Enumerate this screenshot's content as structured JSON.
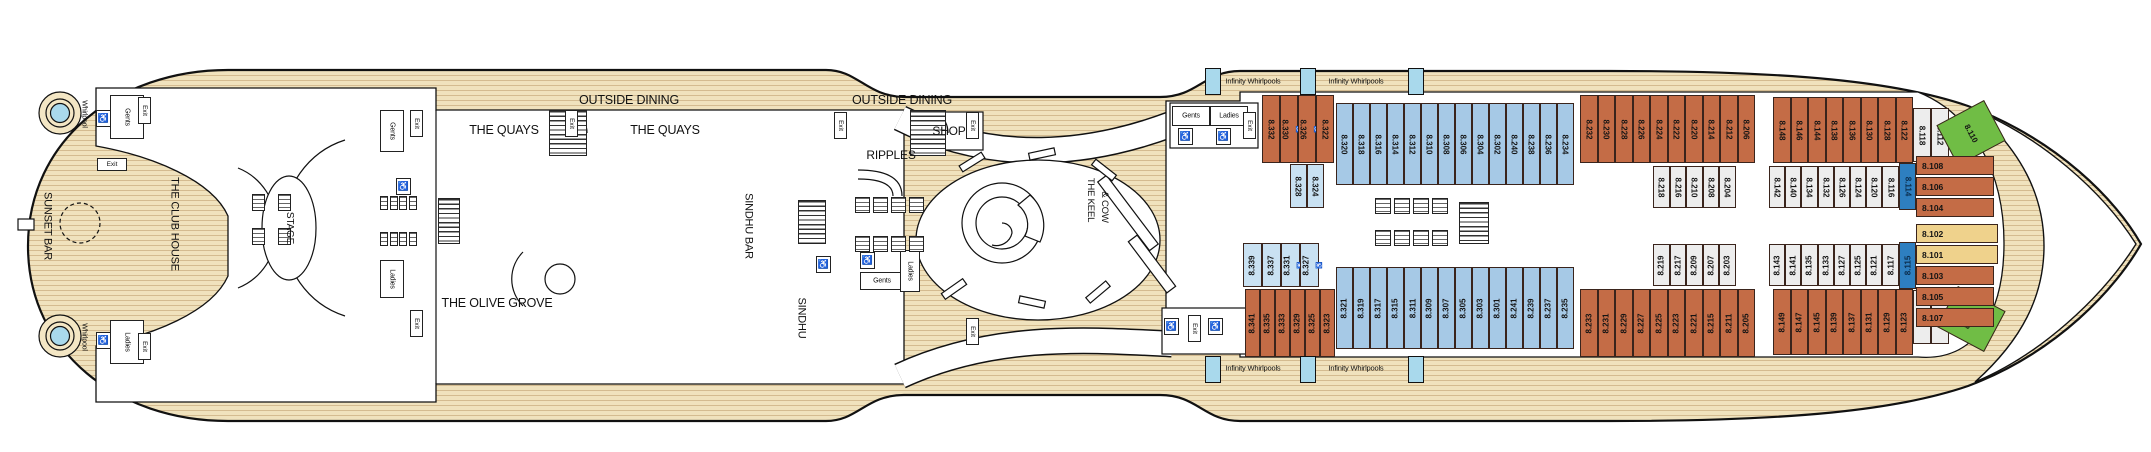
{
  "deck_plan": {
    "venues": {
      "sunset_bar": "SUNSET BAR",
      "club_house": "THE CLUB HOUSE",
      "stage": "STAGE",
      "quays": "THE QUAYS",
      "outside_dining": "OUTSIDE DINING",
      "olive_grove": "THE OLIVE GROVE",
      "sindhu_bar": "SINDHU BAR",
      "sindhu": "SINDHU",
      "ripples": "RIPPLES",
      "shop": "SHOP",
      "keel": "THE KEEL",
      "cow": "& COW",
      "infinity": "Infinity Whirlpools",
      "whirlpool": "Whirlpool",
      "gents": "Gents",
      "ladies": "Ladies",
      "exit": "Exit"
    },
    "colors": {
      "orange": "#c46c46",
      "blue": "#a6c9e6",
      "lightblue": "#c9e1f2",
      "white": "#ededed",
      "darkblue": "#2e7fc0",
      "yellow": "#efd28c",
      "green": "#70bd45",
      "wood": "#f0e2bd",
      "whirlpool_blue": "#a9d9ec"
    },
    "accessible_cabins": [
      "8.330",
      "8.326",
      "8.331",
      "8.327"
    ],
    "cabin_groups": [
      {
        "id": "top-orange-aft",
        "color": "orange",
        "cabins": [
          "8.332",
          "8.330",
          "8.326",
          "8.322"
        ]
      },
      {
        "id": "top-blue",
        "color": "blue",
        "cabins": [
          "8.320",
          "8.318",
          "8.316",
          "8.314",
          "8.312",
          "8.310",
          "8.308",
          "8.306",
          "8.304",
          "8.302",
          "8.240",
          "8.238",
          "8.236",
          "8.234"
        ]
      },
      {
        "id": "top-orange-mid",
        "color": "orange",
        "cabins": [
          "8.232",
          "8.230",
          "8.228",
          "8.226",
          "8.224",
          "8.222",
          "8.220",
          "8.214",
          "8.212",
          "8.206"
        ]
      },
      {
        "id": "top-orange-fwd",
        "color": "orange",
        "cabins": [
          "8.148",
          "8.146",
          "8.144",
          "8.138",
          "8.136",
          "8.130",
          "8.128",
          "8.122"
        ]
      },
      {
        "id": "top-white-fwd",
        "color": "white",
        "cabins": [
          "8.118",
          "8.112"
        ]
      },
      {
        "id": "top-green",
        "color": "green",
        "cabins": [
          "8.110"
        ]
      },
      {
        "id": "mid-top-aft",
        "color": "lightblue",
        "cabins": [
          "8.328",
          "8.324"
        ]
      },
      {
        "id": "mid-top-mid",
        "color": "white",
        "cabins": [
          "8.218",
          "8.216",
          "8.210",
          "8.208",
          "8.204"
        ]
      },
      {
        "id": "mid-top-fwd",
        "color": "white",
        "cabins": [
          "8.142",
          "8.140",
          "8.134",
          "8.132",
          "8.126",
          "8.124",
          "8.120",
          "8.116"
        ]
      },
      {
        "id": "mid-top-suite",
        "color": "darkblue",
        "cabins": [
          "8.114"
        ]
      },
      {
        "id": "mid-bot-aft",
        "color": "lightblue",
        "cabins": [
          "8.339",
          "8.337",
          "8.331",
          "8.327"
        ]
      },
      {
        "id": "mid-bot-mid",
        "color": "white",
        "cabins": [
          "8.219",
          "8.217",
          "8.209",
          "8.207",
          "8.203"
        ]
      },
      {
        "id": "mid-bot-fwd",
        "color": "white",
        "cabins": [
          "8.143",
          "8.141",
          "8.135",
          "8.133",
          "8.127",
          "8.125",
          "8.121",
          "8.117"
        ]
      },
      {
        "id": "mid-bot-suite",
        "color": "darkblue",
        "cabins": [
          "8.115"
        ]
      },
      {
        "id": "bot-orange-aft",
        "color": "orange",
        "cabins": [
          "8.341",
          "8.335",
          "8.333",
          "8.329",
          "8.325",
          "8.323"
        ]
      },
      {
        "id": "bot-blue",
        "color": "blue",
        "cabins": [
          "8.321",
          "8.319",
          "8.317",
          "8.315",
          "8.311",
          "8.309",
          "8.307",
          "8.305",
          "8.303",
          "8.301",
          "8.241",
          "8.239",
          "8.237",
          "8.235"
        ]
      },
      {
        "id": "bot-orange-mid",
        "color": "orange",
        "cabins": [
          "8.233",
          "8.231",
          "8.229",
          "8.227",
          "8.225",
          "8.223",
          "8.221",
          "8.215",
          "8.211",
          "8.205"
        ]
      },
      {
        "id": "bot-orange-fwd",
        "color": "orange",
        "cabins": [
          "8.149",
          "8.147",
          "8.145",
          "8.139",
          "8.137",
          "8.131",
          "8.129",
          "8.123"
        ]
      },
      {
        "id": "bot-white-fwd",
        "color": "white",
        "cabins": [
          "8.119",
          "8.111"
        ]
      },
      {
        "id": "bot-green",
        "color": "green",
        "cabins": [
          "8.109"
        ]
      },
      {
        "id": "bow-orange-top",
        "color": "orange",
        "cabins": [
          "8.108",
          "8.106",
          "8.104"
        ]
      },
      {
        "id": "bow-yellow",
        "color": "yellow",
        "cabins": [
          "8.102",
          "8.101"
        ]
      },
      {
        "id": "bow-orange-bot",
        "color": "orange",
        "cabins": [
          "8.103",
          "8.105",
          "8.107"
        ]
      }
    ]
  }
}
